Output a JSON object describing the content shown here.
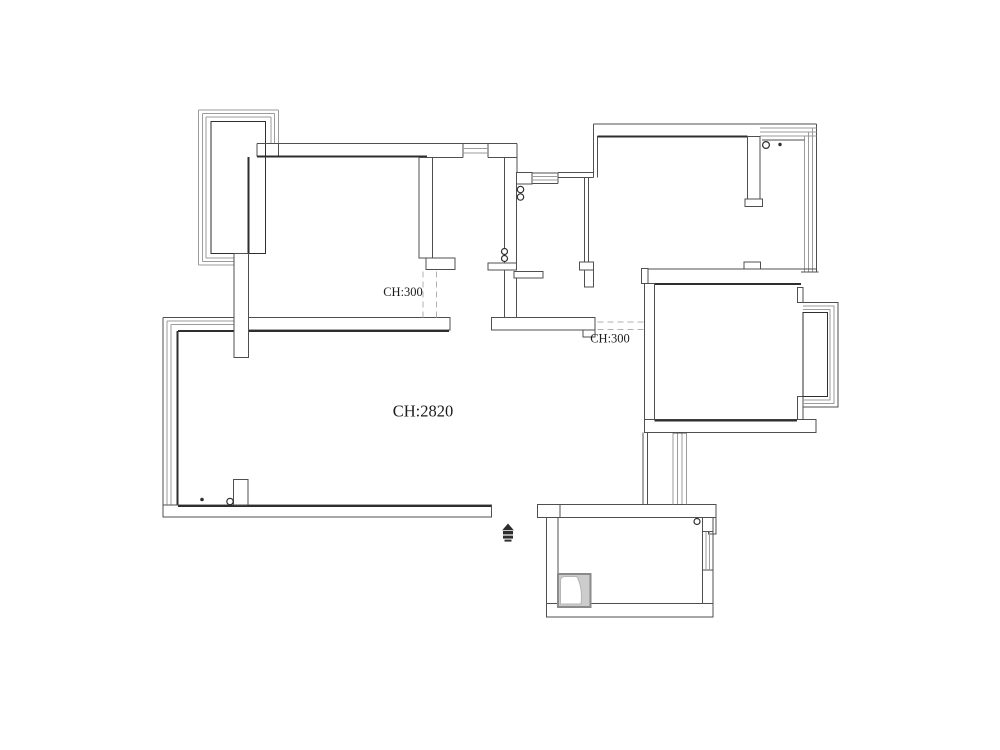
{
  "labels": {
    "left_opening_height": "CH:300",
    "right_opening_height": "CH:300",
    "ceiling_height": "CH:2820"
  },
  "symbols": {
    "entry_marker": "entry-marker-icon",
    "sink": "kitchen-sink",
    "pipe_circles": "plumbing-pipe-circle",
    "point_markers": "point-dot",
    "windows": "window-hatch",
    "bay_windows": "bay-window",
    "dashed_openings": "door-opening-dashed"
  },
  "colors": {
    "background": "#ffffff",
    "wall_line": "#4f4f4f",
    "wall_dark": "#2e2e2e",
    "window_line": "#9b9b9b",
    "dashed_line": "#b0b0b0",
    "label_text": "#1c1c1c",
    "sink_fill": "#cccccc",
    "sink_border": "#8a8a8a"
  }
}
